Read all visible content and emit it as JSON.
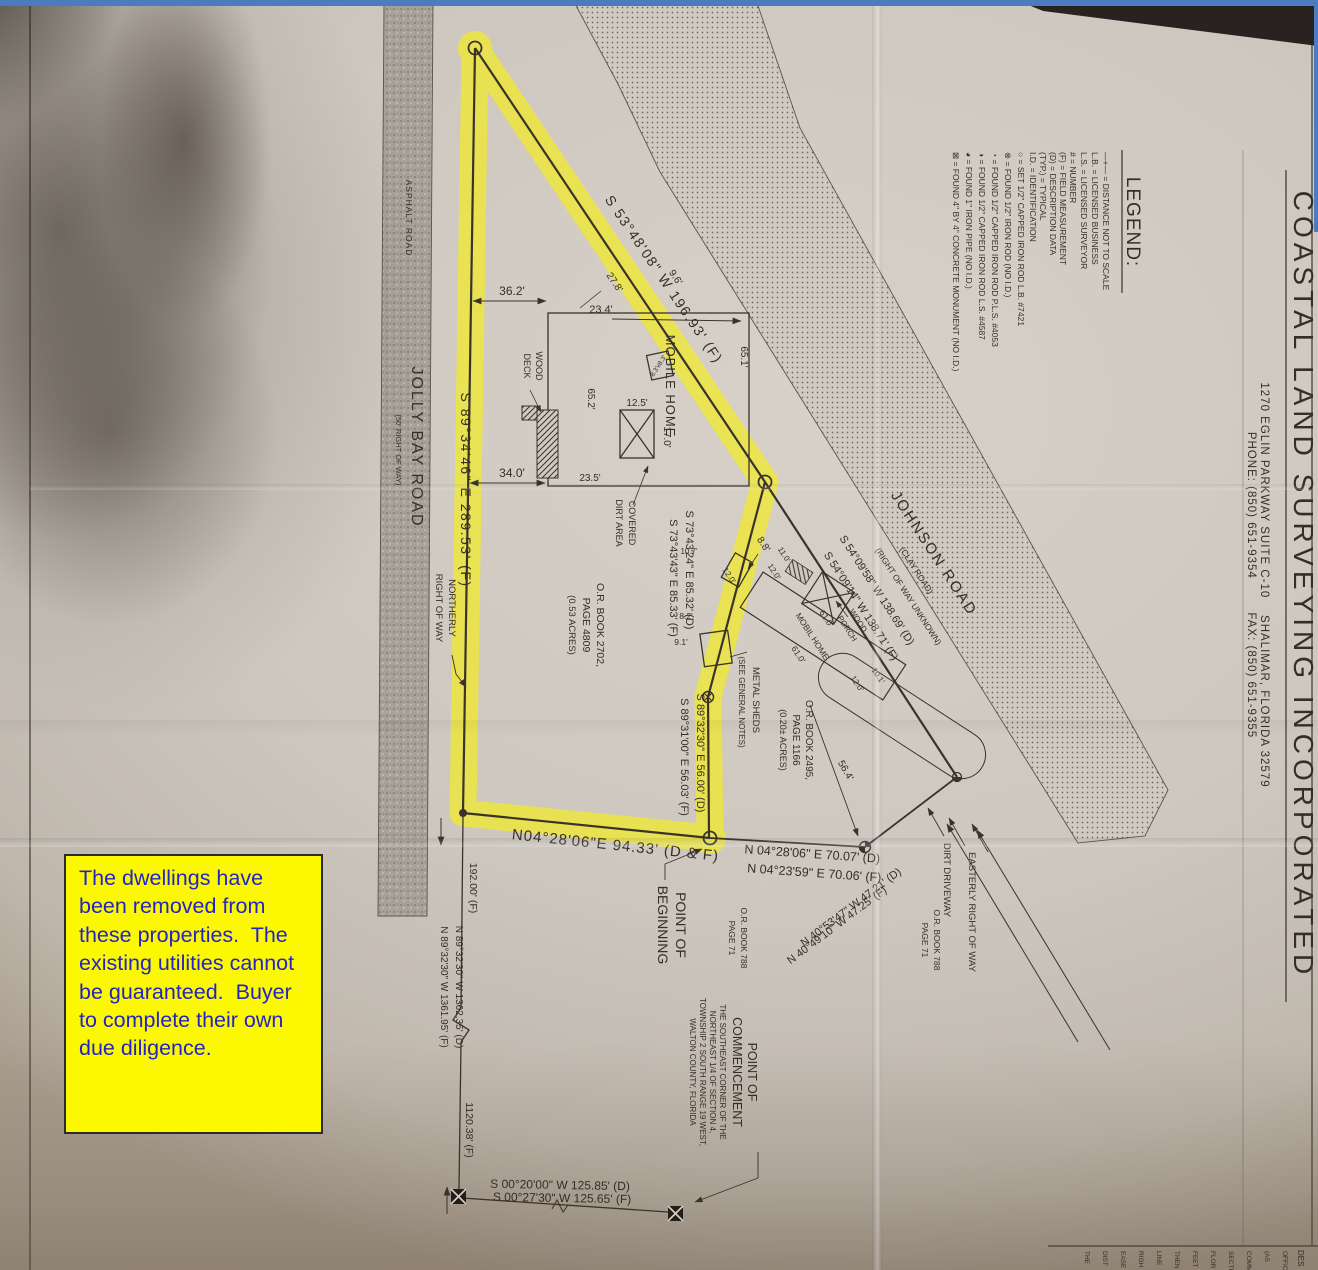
{
  "note": {
    "text": "The dwellings have been removed from these properties.  The existing utilities cannot be guaranteed.  Buyer to complete their own due diligence."
  },
  "title_block": {
    "company": "COASTAL LAND SURVEYING INCORPORATED",
    "address": "1270 EGLIN PARKWAY SUITE C-10    SHALIMAR, FLORIDA 32579",
    "phone_fax": "PHONE: (850) 651-9354        FAX: (850) 651-9355"
  },
  "legend": {
    "title": "LEGEND:",
    "items": [
      "—+— = DISTANCE NOT TO SCALE",
      "L.B. = LICENSED BUSINESS",
      "L.S. = LICENSED SURVEYOR",
      "# = NUMBER",
      "(F) = FIELD MEASUREMENT",
      "(D) = DESCRIPTION DATA",
      "(TYP.) = TYPICAL",
      "I.D. = IDENTIFICATION",
      "○ = SET 1/2\" CAPPED IRON ROD L.B. #7421",
      "⊗ = FOUND 1/2\" IRON ROD (NO I.D.)",
      "◔ = FOUND 1/2\" CAPPED IRON ROD P.L.S. #4053",
      "◑ = FOUND 1/2\" CAPPED IRON ROD L.S. #4587",
      "◕ = FOUND 1\" IRON PIPE (NO I.D.)",
      "⊠ = FOUND 4\" BY 4\" CONCRETE MONUMENT (NO I.D.)"
    ]
  },
  "roads": {
    "jolly_name": "JOLLY BAY ROAD",
    "jolly_row": "(50' RIGHT OF WAY)",
    "asphalt": "ASPHALT ROAD",
    "johnson_name": "JOHNSON ROAD",
    "johnson_type": "(CLAY ROAD)",
    "johnson_row": "(RIGHT OF WAY UNKNOWN)"
  },
  "bearings": {
    "west": "S 89°34'46\" E  289.53' (F)",
    "ne": "S 53°48'08\" W 196.93' (F)",
    "e1d": "S 73°43'24\" E  85.32' (D)",
    "e1f": "S 73°43'43\" E  85.33' (F)",
    "e2d": "S 89°32'30\" E  56.00' (D)",
    "e2f": "S 89°31'00\" E  56.03' (F)",
    "south": "N04°28'06\"E   94.33'  (D & F)",
    "s2d": "N 04°28'06\" E    70.07'  (D)",
    "s2f": "N 04°23'59\" E    70.06'  (F)",
    "jd": "S 54°09'58\" W  138.69' (D)",
    "jf": "S 54°09'14\" W  138.71' (F)",
    "nwd": "N 40°53'47\" W  47.21' (D)",
    "nwf": "N 40°49'10\" W  47.25' (F)",
    "d564": "56.4'",
    "w192": "192.00' (F)",
    "secd": "N 89°32'30\" W 1362.35' (D)",
    "secf": "N 89°32'30\" W 1361.95' (F)",
    "w1120": "1120.38' (F)",
    "botd": "S 00°20'00\" W 125.85' (D)",
    "botf": "S 00°27'30\" W 125.65' (F)"
  },
  "labels": {
    "mobile_home": "MOBILE HOME",
    "wood": "WOOD",
    "deck": "DECK",
    "covered": "COVERED",
    "dirt_area": "DIRT AREA",
    "metal_sheds": "METAL SHEDS",
    "see_notes": "(SEE GENERAL NOTES)",
    "northerly": "NORTHERLY",
    "row": "RIGHT OF WAY",
    "point_of": "POINT OF",
    "beginning": "BEGINNING",
    "commencement": "COMMENCEMENT",
    "poc1": "THE SOUTHEAST CORNER OF THE",
    "poc2": "NORTHEAST 1/4 OF SECTION 4,",
    "poc3": "TOWNSHIP 2 SOUTH RANGE 19 WEST,",
    "poc4": "WALTON COUNTY, FLORIDA",
    "or2702": "O.R. BOOK 2702,",
    "pg4809": "PAGE 4809",
    "ac053": "(0.53 ACRES)",
    "or2495": "O.R. BOOK 2495,",
    "pg1166": "PAGE 1166",
    "ac020": "(0.20± ACRES)",
    "or788": "O.R. BOOK 788",
    "pg71": "PAGE 71",
    "dirt_driveway": "DIRT DRIVEWAY",
    "easterly": "EASTERLY RIGHT OF WAY",
    "mobil_home": "MOBIL HOME",
    "porch": "PORCH"
  },
  "dims": {
    "d36": "36.2'",
    "d234": "23.4'",
    "d652": "65.2'",
    "d651": "65.1'",
    "d340": "34.0'",
    "d235": "23.5'",
    "d125": "12.5'",
    "d170": "17.0'",
    "d278": "27.8'",
    "d96": "9.6'",
    "d88": "8.8'",
    "d107": "10.7'",
    "d120a": "12.0'",
    "d82": "8.2'",
    "d91": "9.1'",
    "d83": "8.3'x8.3'",
    "d610a": "61.0'",
    "d610b": "61.0'",
    "d110": "11.0'",
    "d120b": "12.0'",
    "d101": "10.1'",
    "d120c": "12.0'"
  },
  "strip": {
    "header": "DES",
    "f0": "OFFIC",
    "f1": "(AS",
    "f2": "COMM",
    "f3": "SECTI",
    "f4": "FLOR",
    "f5": "FEET",
    "f6": "THEN",
    "f7": "LINE",
    "f8": "RIGH",
    "f9": "EASE",
    "f10": "DIST",
    "f11": "THE"
  }
}
